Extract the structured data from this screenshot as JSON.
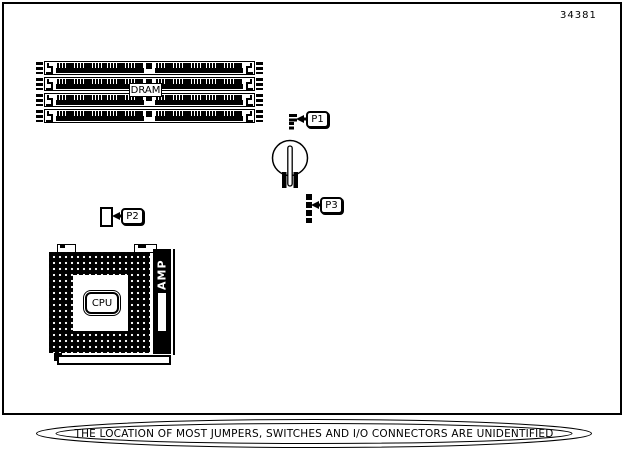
{
  "page": {
    "part_number": "34381",
    "ink_color": "#000000",
    "paper_color": "#ffffff"
  },
  "diagram": {
    "dram": {
      "label": "DRAM",
      "slot_count": 4
    },
    "cpu": {
      "label": "CPU"
    },
    "amp": {
      "label": "AMP"
    },
    "jumpers": [
      {
        "id": "P1"
      },
      {
        "id": "P2"
      },
      {
        "id": "P3"
      }
    ],
    "caption": "THE LOCATION OF MOST JUMPERS, SWITCHES AND I/O CONNECTORS ARE UNIDENTIFIED"
  }
}
